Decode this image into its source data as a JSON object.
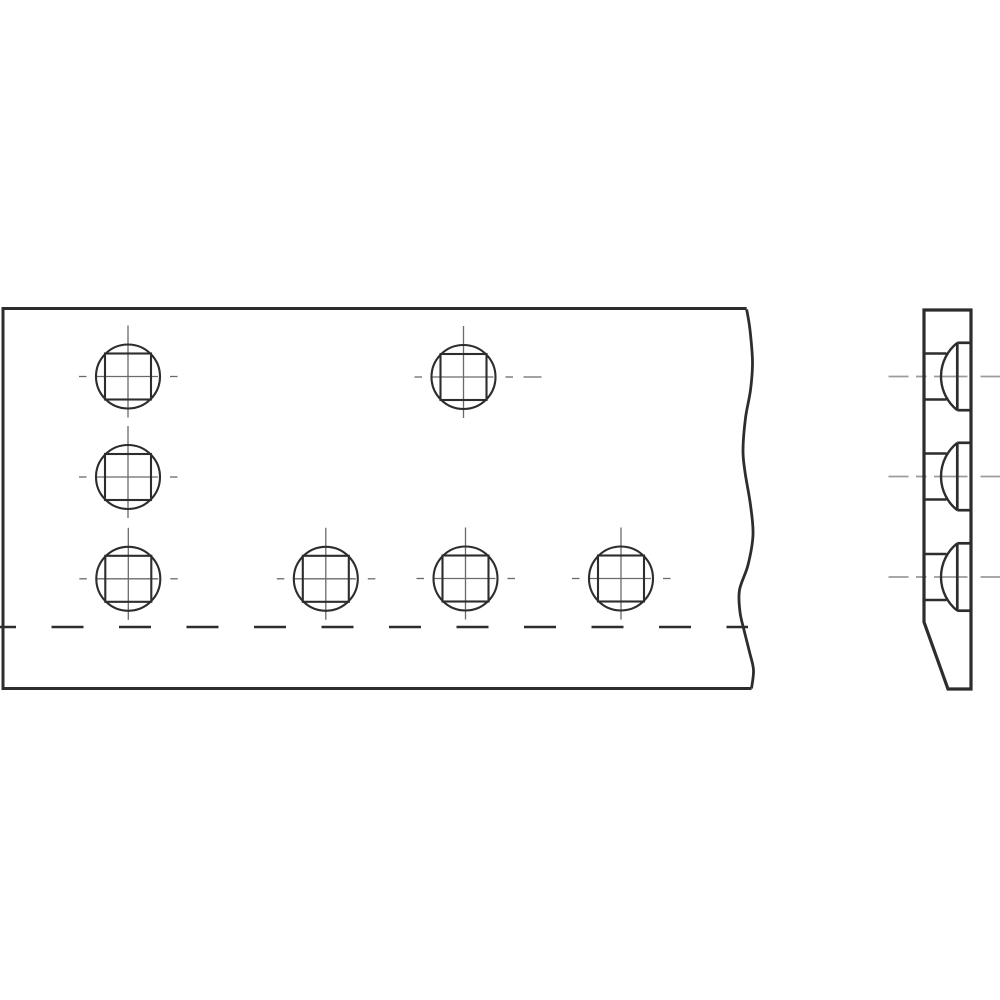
{
  "canvas": {
    "width": 1000,
    "height": 1000,
    "background": "#ffffff"
  },
  "style": {
    "line_color": "#2d2d2d",
    "centerline_color": "#6a6a6a",
    "side_centerline_color": "#9b9b9b",
    "outline_width": 3,
    "break_line_width": 2.8,
    "bend_line_width": 2.6,
    "hole_stroke_width": 2.1,
    "centerline_width": 1.3,
    "side_outline_width": 3.2,
    "neck_line_width": 2.4,
    "head_line_width": 2.7,
    "side_centerline_width": 1.8
  },
  "front_view": {
    "left": 3,
    "top": 308.5,
    "bottom": 688.5,
    "break_x_top": 746.7,
    "break_x_bottom": 751.5,
    "break_line_points": [
      [
        746.7,
        309.5
      ],
      [
        750.0,
        330
      ],
      [
        752.5,
        362
      ],
      [
        750.5,
        390
      ],
      [
        745.5,
        418
      ],
      [
        743.0,
        450
      ],
      [
        745.0,
        472
      ],
      [
        750.5,
        505
      ],
      [
        753.0,
        535
      ],
      [
        748.0,
        565
      ],
      [
        739.5,
        590
      ],
      [
        740.0,
        612
      ],
      [
        744.0,
        630
      ],
      [
        749.5,
        652
      ],
      [
        753.5,
        670
      ],
      [
        751.5,
        688.5
      ]
    ],
    "bend_line": {
      "y": 627,
      "x_start": 0,
      "x_end": 748,
      "dash": [
        32,
        35.5
      ],
      "dash_offset": 16
    },
    "hole_radius": 32,
    "square_side": 46,
    "centerline": {
      "vertical_from": -51,
      "vertical_to": 41,
      "horizontal_main_from": -32.5,
      "horizontal_main_to": 30,
      "left_dash": [
        -49,
        -41.5
      ],
      "right_dash": [
        42,
        49.5
      ]
    },
    "holes": [
      {
        "id": "hole-row1-col1",
        "x": 128,
        "y": 376.5
      },
      {
        "id": "hole-row1-col3",
        "x": 463.5,
        "y": 377,
        "extra_dash": [
          60,
          78
        ]
      },
      {
        "id": "hole-row2-col1",
        "x": 128,
        "y": 477
      },
      {
        "id": "hole-row3-col1",
        "x": 128.3,
        "y": 578.8
      },
      {
        "id": "hole-row3-col2",
        "x": 325.8,
        "y": 578.8
      },
      {
        "id": "hole-row3-col3",
        "x": 465.5,
        "y": 578.5
      },
      {
        "id": "hole-row3-col4",
        "x": 621,
        "y": 578.5
      }
    ]
  },
  "side_view": {
    "left": 924,
    "right": 971,
    "top": 310,
    "bottom": 689,
    "chamfer_start_y": 622,
    "chamfer_bottom_x": 948,
    "bolt_rows_y": [
      376.5,
      476.5,
      577
    ],
    "bolt_head": {
      "neck_half_height": 23,
      "neck_end_x": 946.5,
      "chord_x": 957.3,
      "head_half_height": 33.7,
      "dome_arc_radius": 43
    },
    "centerline_segments": [
      [
        888.5,
        908.5
      ],
      [
        916,
        926.5
      ],
      [
        934,
        967.5
      ],
      [
        980.5,
        1000
      ]
    ]
  }
}
